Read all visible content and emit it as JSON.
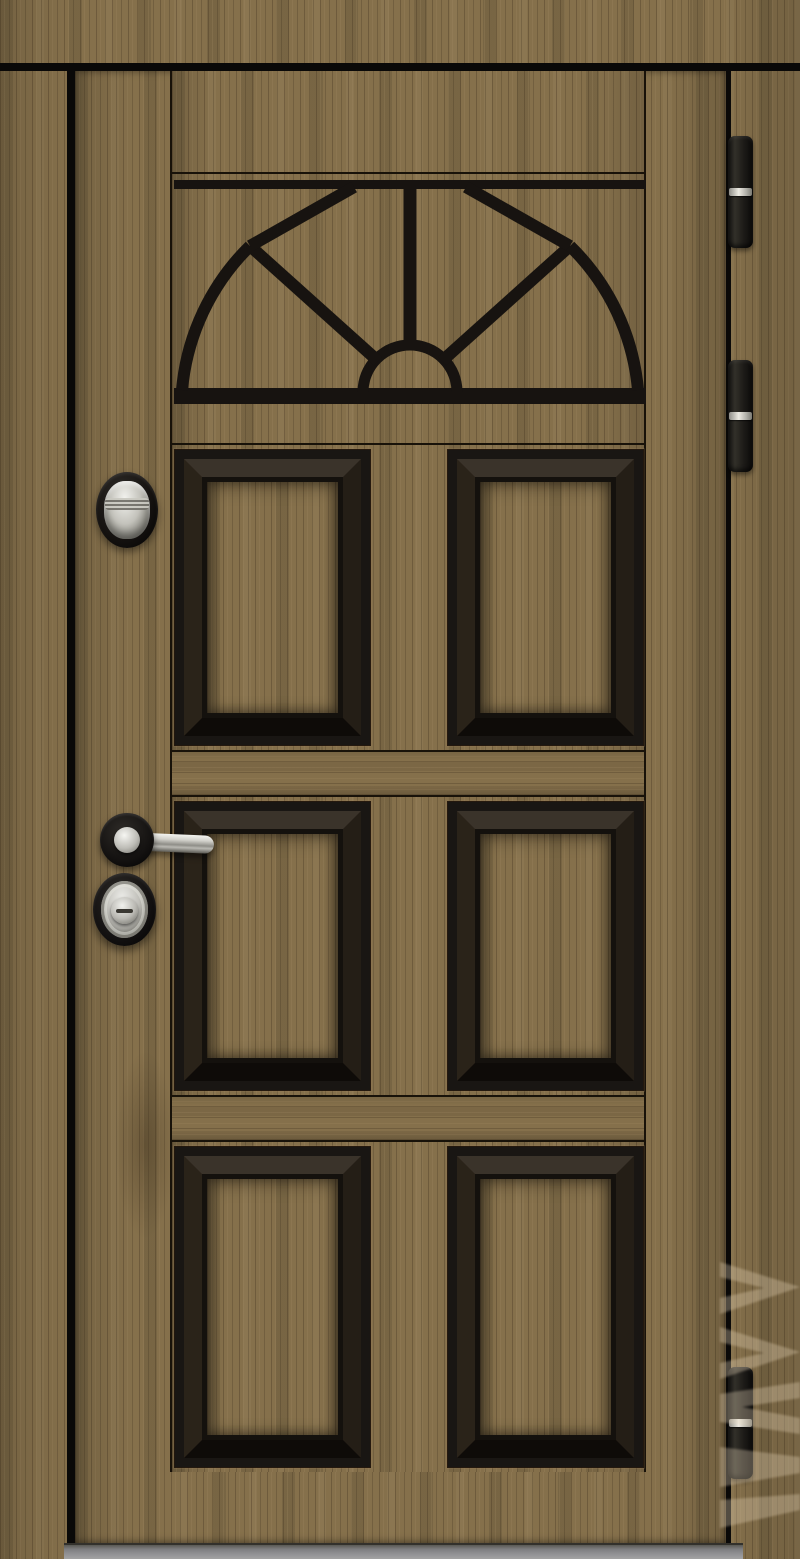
{
  "image": {
    "type": "product-photo",
    "subject": "Steel entry door, dark oak wood-grain finish with black applied moldings, sunburst fan decor panel, six raised panels, chrome hardware",
    "width_px": 800,
    "height_px": 1559
  },
  "door": {
    "finish": "dark brushed oak laminate, vertical grain",
    "frame": "matching wood-grain casing on all sides",
    "decor_field": {
      "top_strip": true,
      "sunburst_fan_panel": {
        "rays": 3,
        "outer_arcs": 2,
        "central_arch": true
      },
      "raised_panel_rows": 3,
      "raised_panel_columns": 2,
      "raised_panels_total": 6,
      "molding_style": "black beveled square moldings"
    },
    "hinges": {
      "count": 3,
      "style": "black barrel hinges with chrome center ring",
      "side": "right"
    },
    "threshold": "gray metal sill at bottom"
  },
  "hardware": {
    "side": "left",
    "upper_lock": "oval black escutcheon with chrome cylinder cover and ridged thumb grip",
    "handle": "chrome lever handle on round black rosette",
    "lower_lock": "oval black armored escutcheon with concentric chrome plate and cylinder with slot"
  },
  "watermark": {
    "visible": true,
    "legible": false,
    "position": "bottom-right edge, vertical",
    "opacity": 0.32
  },
  "colors": {
    "wood-base": "#85704b",
    "wood-dark": "#5e4c33",
    "wood-light": "#9b8560",
    "molding": "#191613",
    "gap": "#0a0908",
    "chrome-light": "#f2f2ee",
    "chrome-dark": "#57564f",
    "threshold-gray": "#8f8f92",
    "watermark-tint": "#ead9bd"
  }
}
